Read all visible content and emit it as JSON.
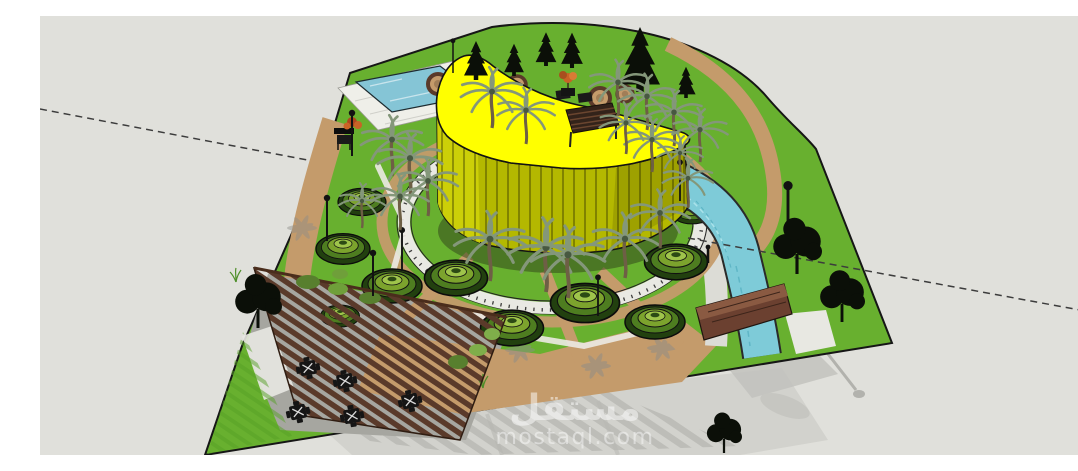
{
  "scene": {
    "description": "3D SketchUp-style render of a park landscape design: curved yellow central building on a circular plaza, terraced green mounds, palm trees, swimming pool, water canal with wooden bridge, and a slatted wooden pergola seating area",
    "background": "#e0e0db"
  },
  "watermark": {
    "name_arabic": "مستقل",
    "domain": "mostaql.com",
    "color": "#ffffff"
  },
  "colors": {
    "bg": "#e0e0db",
    "grass": "#68b02f",
    "grass_stripe": "#55a026",
    "path_tan": "#c49b6b",
    "paving_gray": "#a6a6a0",
    "walk_light": "#dcdcd6",
    "deck_white": "#efefe9",
    "gravel_white": "#e8e8e2",
    "pool_water": "#85c5d6",
    "canal_water": "#7ecbd8",
    "ripple_light": "#a9e2ea",
    "roof_yellow": "#ffff00",
    "wall_olive": "#b4b800",
    "wall_face_light": "#cdd008",
    "wall_stripe": "#3f3f00",
    "wood_dark": "#5a3a2a",
    "bridge_wood": "#6b4030",
    "bridge_deck": "#8a5a42",
    "mound_dark": "#22400f",
    "mound_mid": "#4e7d20",
    "mound_light": "#7ca32d",
    "mound_pale": "#9fc44b",
    "tree_dark": "#0b0f08",
    "palm_frond": "#84977a",
    "palm_trunk": "#6e5f45",
    "shadow_base": "#d2d2cd",
    "shadow_stripe": "#bdbdb8",
    "shrub_orange": "#c86326",
    "shrub_red": "#b0461e",
    "outline": "#161616",
    "guide": "#3c3c3c",
    "watermark": "#ffffff"
  }
}
